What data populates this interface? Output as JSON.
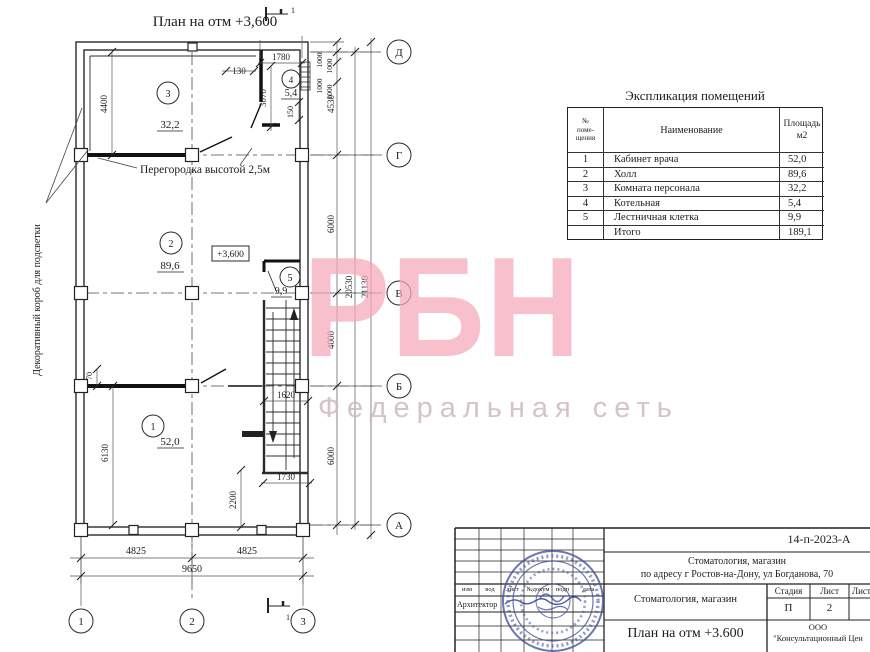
{
  "watermark": {
    "big": "РБН",
    "tagline": "Федеральная сеть"
  },
  "plan": {
    "title": "План на отм  +3,600",
    "elevation": "+3,600",
    "partition_note": "Перегородка высотой 2,5м",
    "side_note": "Декоративный короб для подсветки",
    "section_mark": "1",
    "rooms": [
      {
        "num": "1",
        "area": "52,0"
      },
      {
        "num": "2",
        "area": "89,6"
      },
      {
        "num": "3",
        "area": "32,2"
      },
      {
        "num": "4",
        "area": "5,4"
      },
      {
        "num": "5",
        "area": "9,9"
      }
    ],
    "row_axes": [
      "Д",
      "Г",
      "В",
      "Б",
      "А"
    ],
    "col_axes": [
      "1",
      "2",
      "3"
    ],
    "dims": {
      "d130": "130",
      "d1780": "1780",
      "d3070": "3070",
      "d150": "150",
      "d1000": "1000",
      "d4530": "4530",
      "d6000a": "6000",
      "d4000": "4000",
      "d6000b": "6000",
      "d20530": "20530",
      "d21130": "21130",
      "d4400": "4400",
      "d70": "70",
      "d6130": "6130",
      "d4825a": "4825",
      "d4825b": "4825",
      "d9650": "9650",
      "d1620": "1620",
      "d1730": "1730",
      "d2200": "2200"
    }
  },
  "table": {
    "title": "Экспликация помещений",
    "headers": {
      "num_l1": "№",
      "num_l2": "поме-",
      "num_l3": "щения",
      "name": "Наименование",
      "area_l1": "Площадь",
      "area_l2": "м2"
    },
    "rows": [
      {
        "num": "1",
        "name": "Кабинет врача",
        "area": "52,0"
      },
      {
        "num": "2",
        "name": "Холл",
        "area": "89,6"
      },
      {
        "num": "3",
        "name": "Комната персонала",
        "area": "32,2"
      },
      {
        "num": "4",
        "name": "Котельная",
        "area": "5,4"
      },
      {
        "num": "5",
        "name": "Лестничная клетка",
        "area": "9,9"
      },
      {
        "num": "",
        "name": "Итого",
        "area": "189,1"
      }
    ]
  },
  "titleblock": {
    "doc_no": "14-п-2023-А",
    "project_l1": "Стоматология, магазин",
    "project_l2": "по адресу  г  Ростов-на-Дону,  ул  Богданова, 70",
    "object_name": "Стоматология, магазин",
    "stage_h": "Стадия",
    "sheet_h": "Лист",
    "sheets_h": "Листо",
    "stage": "П",
    "sheet": "2",
    "drawing_name": "План на отм  +3.600",
    "org_l1": "ООО",
    "org_l2": "\"Консультационный Цен",
    "rev_headers": [
      "изм",
      "вод",
      "лист",
      "№докум",
      "подп",
      "дата"
    ],
    "role": "Архитектор"
  }
}
